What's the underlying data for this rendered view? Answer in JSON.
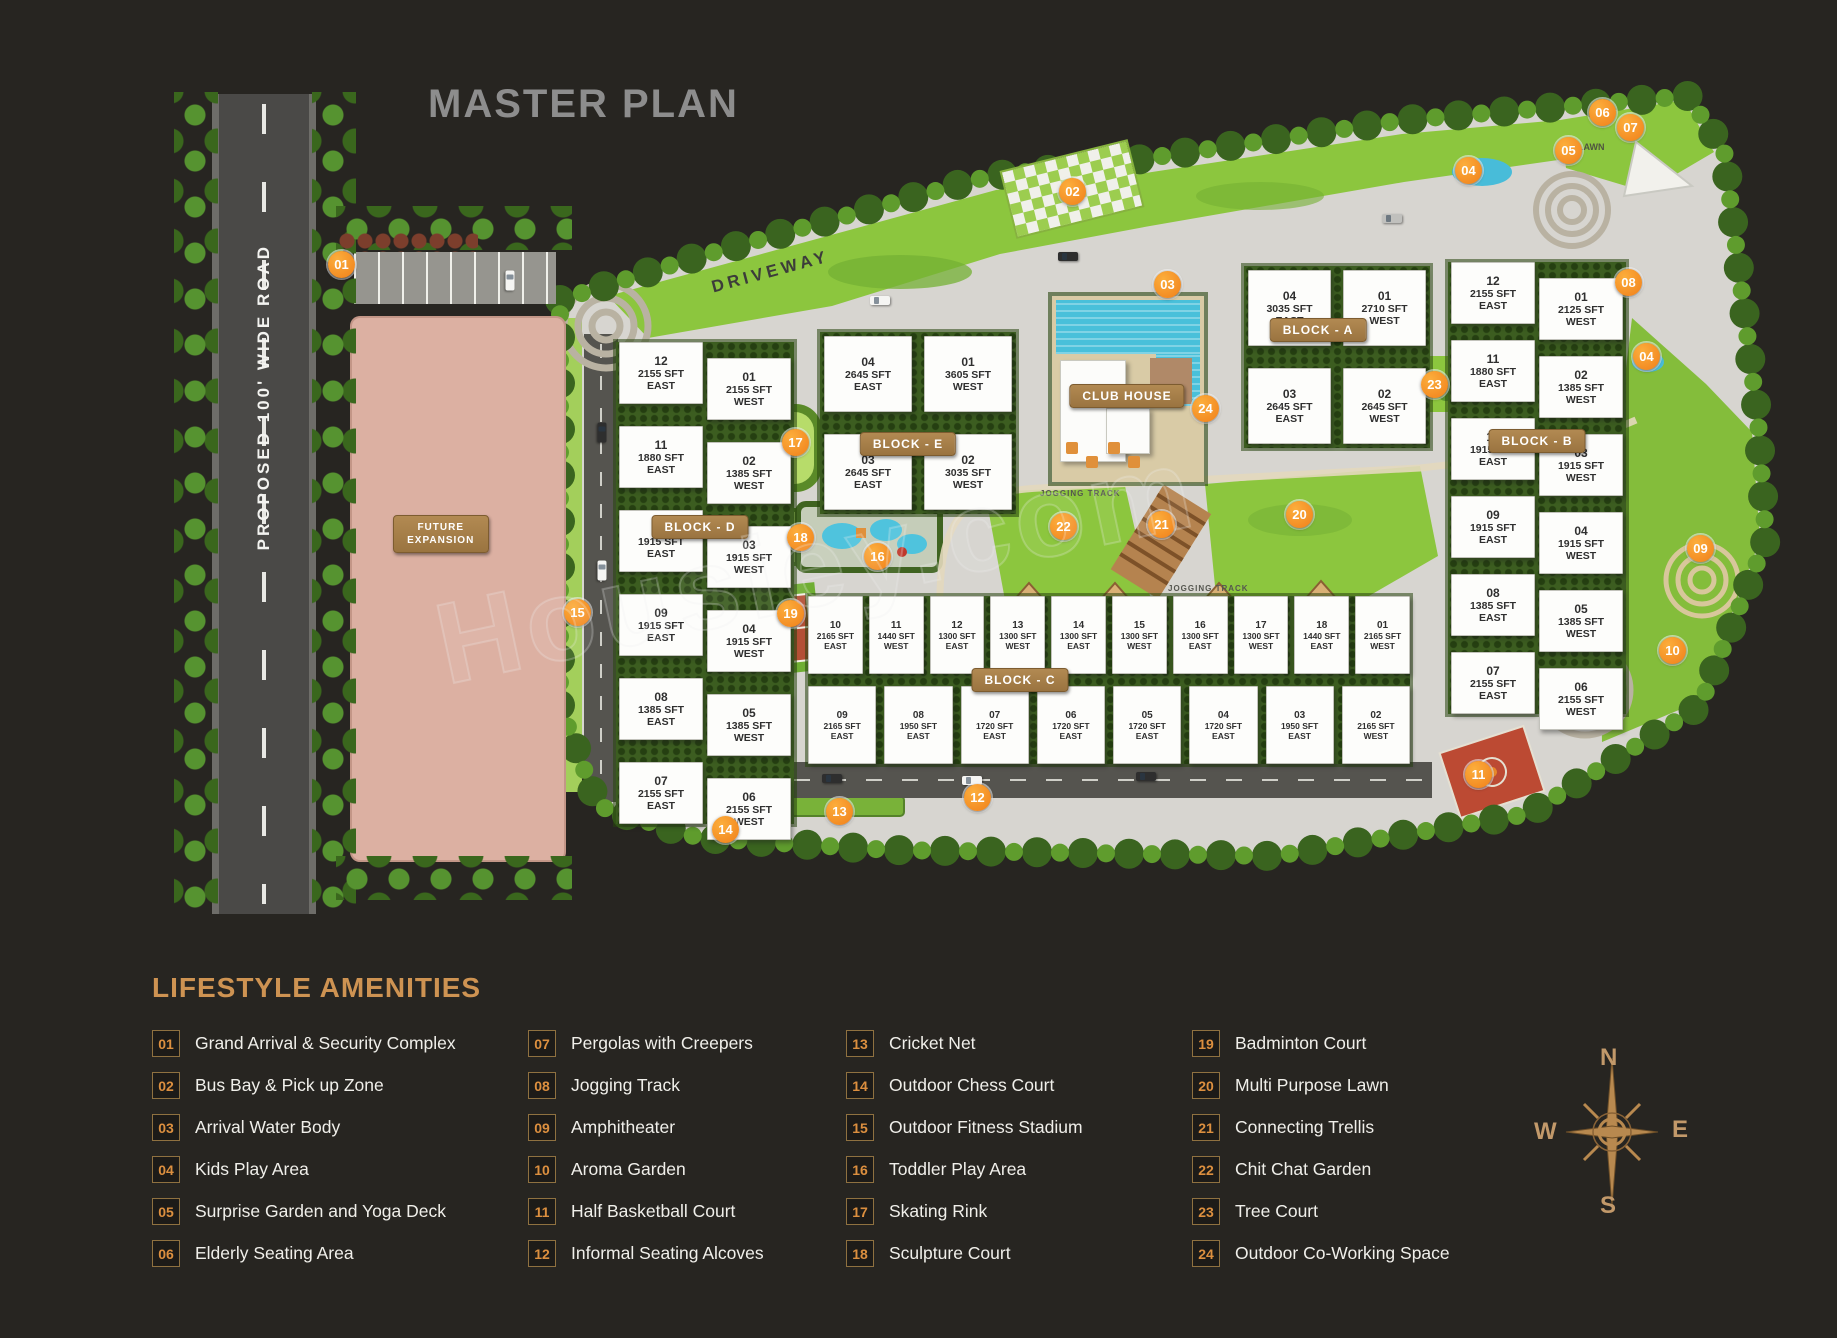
{
  "title": "MASTER PLAN",
  "road_label": "PROPOSED 100' WIDE ROAD",
  "future_expansion": "FUTURE EXPANSION",
  "driveway_label": "DRIVEWAY",
  "club_house_label": "CLUB HOUSE",
  "jogging_track_label": "JOGGING TRACK",
  "lawn_label": "LAWN",
  "watermark": "Housiey.com",
  "compass": {
    "n": "N",
    "e": "E",
    "s": "S",
    "w": "W"
  },
  "blocks": {
    "d": {
      "label": "BLOCK - D",
      "east": [
        {
          "num": "12",
          "sft": "2155 SFT",
          "dir": "EAST"
        },
        {
          "num": "11",
          "sft": "1880 SFT",
          "dir": "EAST"
        },
        {
          "num": "10",
          "sft": "1915 SFT",
          "dir": "EAST"
        },
        {
          "num": "09",
          "sft": "1915 SFT",
          "dir": "EAST"
        },
        {
          "num": "08",
          "sft": "1385 SFT",
          "dir": "EAST"
        },
        {
          "num": "07",
          "sft": "2155 SFT",
          "dir": "EAST"
        }
      ],
      "west": [
        {
          "num": "01",
          "sft": "2155 SFT",
          "dir": "WEST"
        },
        {
          "num": "02",
          "sft": "1385 SFT",
          "dir": "WEST"
        },
        {
          "num": "03",
          "sft": "1915 SFT",
          "dir": "WEST"
        },
        {
          "num": "04",
          "sft": "1915 SFT",
          "dir": "WEST"
        },
        {
          "num": "05",
          "sft": "1385 SFT",
          "dir": "WEST"
        },
        {
          "num": "06",
          "sft": "2155 SFT",
          "dir": "WEST"
        }
      ]
    },
    "e": {
      "label": "BLOCK - E",
      "units": [
        {
          "num": "04",
          "sft": "2645 SFT",
          "dir": "EAST"
        },
        {
          "num": "01",
          "sft": "3605 SFT",
          "dir": "WEST"
        },
        {
          "num": "03",
          "sft": "2645 SFT",
          "dir": "EAST"
        },
        {
          "num": "02",
          "sft": "3035 SFT",
          "dir": "WEST"
        }
      ]
    },
    "a": {
      "label": "BLOCK - A",
      "units": [
        {
          "num": "04",
          "sft": "3035 SFT",
          "dir": "EAST"
        },
        {
          "num": "01",
          "sft": "2710 SFT",
          "dir": "WEST"
        },
        {
          "num": "03",
          "sft": "2645 SFT",
          "dir": "EAST"
        },
        {
          "num": "02",
          "sft": "2645 SFT",
          "dir": "WEST"
        }
      ]
    },
    "b": {
      "label": "BLOCK - B",
      "east": [
        {
          "num": "12",
          "sft": "2155 SFT",
          "dir": "EAST"
        },
        {
          "num": "11",
          "sft": "1880 SFT",
          "dir": "EAST"
        },
        {
          "num": "10",
          "sft": "1915 SFT",
          "dir": "EAST"
        },
        {
          "num": "09",
          "sft": "1915 SFT",
          "dir": "EAST"
        },
        {
          "num": "08",
          "sft": "1385 SFT",
          "dir": "EAST"
        },
        {
          "num": "07",
          "sft": "2155 SFT",
          "dir": "EAST"
        }
      ],
      "west": [
        {
          "num": "01",
          "sft": "2125 SFT",
          "dir": "WEST"
        },
        {
          "num": "02",
          "sft": "1385 SFT",
          "dir": "WEST"
        },
        {
          "num": "03",
          "sft": "1915 SFT",
          "dir": "WEST"
        },
        {
          "num": "04",
          "sft": "1915 SFT",
          "dir": "WEST"
        },
        {
          "num": "05",
          "sft": "1385 SFT",
          "dir": "WEST"
        },
        {
          "num": "06",
          "sft": "2155 SFT",
          "dir": "WEST"
        }
      ]
    },
    "c": {
      "label": "BLOCK - C",
      "top": [
        {
          "num": "10",
          "sft": "2165 SFT",
          "dir": "EAST"
        },
        {
          "num": "11",
          "sft": "1440 SFT",
          "dir": "WEST"
        },
        {
          "num": "12",
          "sft": "1300 SFT",
          "dir": "EAST"
        },
        {
          "num": "13",
          "sft": "1300 SFT",
          "dir": "WEST"
        },
        {
          "num": "14",
          "sft": "1300 SFT",
          "dir": "EAST"
        },
        {
          "num": "15",
          "sft": "1300 SFT",
          "dir": "WEST"
        },
        {
          "num": "16",
          "sft": "1300 SFT",
          "dir": "EAST"
        },
        {
          "num": "17",
          "sft": "1300 SFT",
          "dir": "WEST"
        },
        {
          "num": "18",
          "sft": "1440 SFT",
          "dir": "EAST"
        },
        {
          "num": "01",
          "sft": "2165 SFT",
          "dir": "WEST"
        }
      ],
      "bottom": [
        {
          "num": "09",
          "sft": "2165 SFT",
          "dir": "EAST"
        },
        {
          "num": "08",
          "sft": "1950 SFT",
          "dir": "EAST"
        },
        {
          "num": "07",
          "sft": "1720 SFT",
          "dir": "EAST"
        },
        {
          "num": "06",
          "sft": "1720 SFT",
          "dir": "EAST"
        },
        {
          "num": "05",
          "sft": "1720 SFT",
          "dir": "EAST"
        },
        {
          "num": "04",
          "sft": "1720 SFT",
          "dir": "EAST"
        },
        {
          "num": "03",
          "sft": "1950 SFT",
          "dir": "EAST"
        },
        {
          "num": "02",
          "sft": "2165 SFT",
          "dir": "WEST"
        }
      ]
    }
  },
  "markers": [
    {
      "n": "01",
      "x": 341,
      "y": 264
    },
    {
      "n": "02",
      "x": 1072,
      "y": 191
    },
    {
      "n": "03",
      "x": 1167,
      "y": 284
    },
    {
      "n": "04",
      "x": 1468,
      "y": 170
    },
    {
      "n": "04",
      "x": 1646,
      "y": 356
    },
    {
      "n": "05",
      "x": 1568,
      "y": 150
    },
    {
      "n": "06",
      "x": 1602,
      "y": 112
    },
    {
      "n": "07",
      "x": 1630,
      "y": 127
    },
    {
      "n": "08",
      "x": 1628,
      "y": 282
    },
    {
      "n": "09",
      "x": 1700,
      "y": 548
    },
    {
      "n": "10",
      "x": 1672,
      "y": 650
    },
    {
      "n": "11",
      "x": 1478,
      "y": 774
    },
    {
      "n": "12",
      "x": 977,
      "y": 797
    },
    {
      "n": "13",
      "x": 839,
      "y": 811
    },
    {
      "n": "14",
      "x": 725,
      "y": 829
    },
    {
      "n": "15",
      "x": 577,
      "y": 612
    },
    {
      "n": "16",
      "x": 877,
      "y": 556
    },
    {
      "n": "17",
      "x": 795,
      "y": 442
    },
    {
      "n": "18",
      "x": 800,
      "y": 537
    },
    {
      "n": "19",
      "x": 790,
      "y": 613
    },
    {
      "n": "20",
      "x": 1299,
      "y": 514
    },
    {
      "n": "21",
      "x": 1161,
      "y": 524
    },
    {
      "n": "22",
      "x": 1063,
      "y": 526
    },
    {
      "n": "23",
      "x": 1434,
      "y": 384
    },
    {
      "n": "24",
      "x": 1205,
      "y": 408
    }
  ],
  "legend": {
    "heading": "LIFESTYLE AMENITIES",
    "col1": [
      {
        "num": "01",
        "label": "Grand Arrival & Security Complex"
      },
      {
        "num": "02",
        "label": "Bus Bay & Pick up Zone"
      },
      {
        "num": "03",
        "label": "Arrival Water Body"
      },
      {
        "num": "04",
        "label": "Kids Play Area"
      },
      {
        "num": "05",
        "label": "Surprise Garden and Yoga Deck"
      },
      {
        "num": "06",
        "label": "Elderly Seating Area"
      }
    ],
    "col2": [
      {
        "num": "07",
        "label": "Pergolas with Creepers"
      },
      {
        "num": "08",
        "label": "Jogging Track"
      },
      {
        "num": "09",
        "label": "Amphitheater"
      },
      {
        "num": "10",
        "label": "Aroma Garden"
      },
      {
        "num": "11",
        "label": "Half Basketball Court"
      },
      {
        "num": "12",
        "label": "Informal Seating Alcoves"
      }
    ],
    "col3": [
      {
        "num": "13",
        "label": "Cricket Net"
      },
      {
        "num": "14",
        "label": "Outdoor Chess Court"
      },
      {
        "num": "15",
        "label": "Outdoor Fitness Stadium"
      },
      {
        "num": "16",
        "label": "Toddler Play Area"
      },
      {
        "num": "17",
        "label": "Skating Rink"
      },
      {
        "num": "18",
        "label": "Sculpture Court"
      }
    ],
    "col4": [
      {
        "num": "19",
        "label": "Badminton Court"
      },
      {
        "num": "20",
        "label": "Multi Purpose Lawn"
      },
      {
        "num": "21",
        "label": "Connecting Trellis"
      },
      {
        "num": "22",
        "label": "Chit Chat Garden"
      },
      {
        "num": "23",
        "label": "Tree Court"
      },
      {
        "num": "24",
        "label": "Outdoor Co-Working Space"
      }
    ]
  }
}
